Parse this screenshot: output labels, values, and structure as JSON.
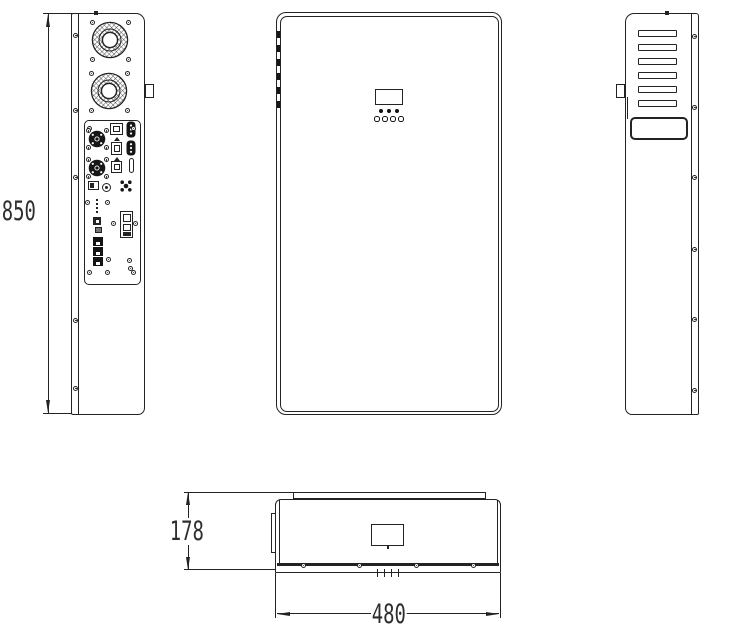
{
  "dimensions": {
    "height": "850",
    "depth": "178",
    "width": "480"
  },
  "style": {
    "line_color": "#232323",
    "background": "#ffffff"
  },
  "components": {
    "left_view": {
      "cooling_fans": 2,
      "connector_panel": true,
      "rj45_ports": 3
    },
    "front_view": {
      "display": true,
      "leds_top_row": 3,
      "leds_bottom_row": 4
    },
    "right_view": {
      "vent_slots": 6,
      "handle": true
    },
    "top_view": {
      "edge_screws": 4,
      "mount_strip": true
    }
  }
}
